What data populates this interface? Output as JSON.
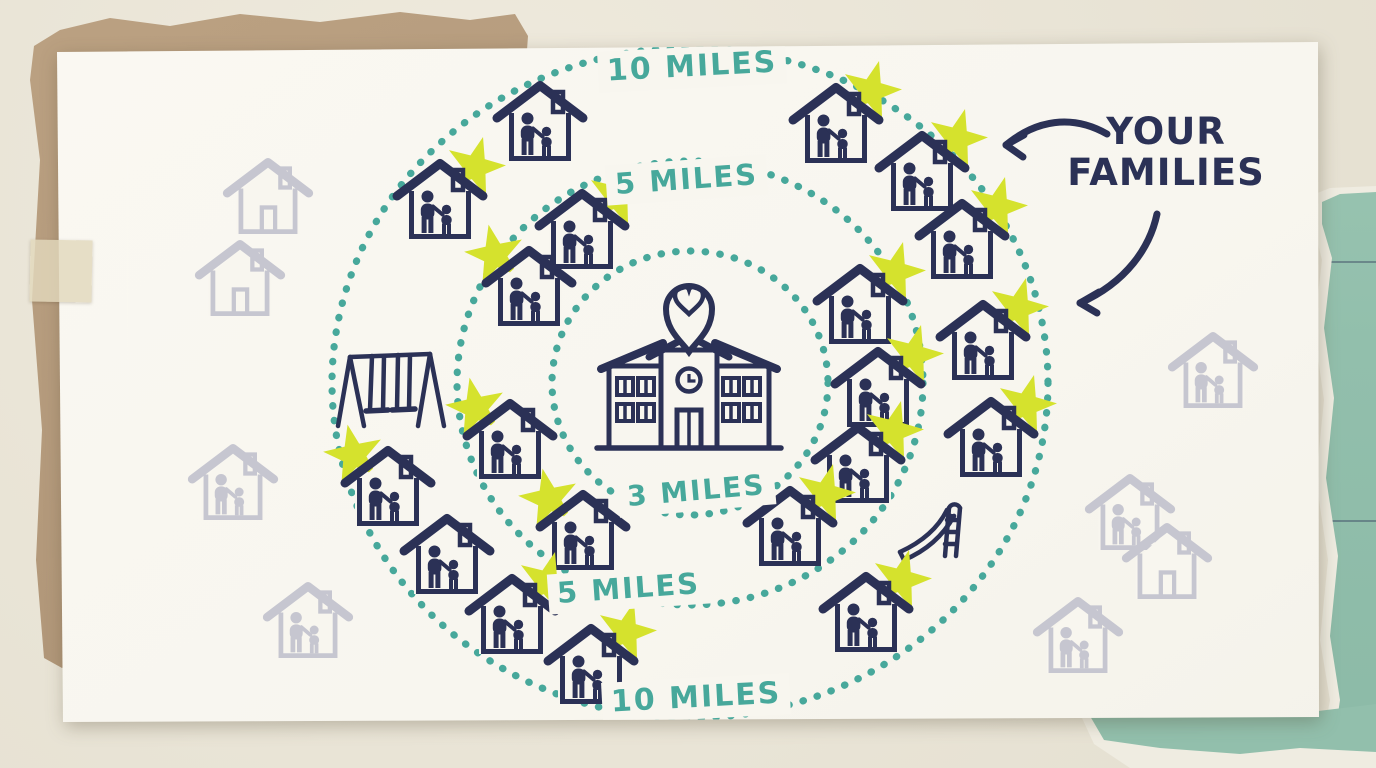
{
  "title": "Your Families radius map illustration",
  "colors": {
    "paper": "#f8f6ef",
    "background": "#e9e4d6",
    "kraft": "#b2987a",
    "teal_paper": "#92bfac",
    "accent_teal": "#47a89b",
    "navy": "#2b3156",
    "star": "#d5e22d",
    "faded": "#c6c6d0"
  },
  "center": {
    "x": 690,
    "y": 383,
    "icon": "school-with-heart-location-pin"
  },
  "rings": [
    {
      "miles": 3,
      "label": "3 MILES",
      "rx": 138,
      "ry": 132
    },
    {
      "miles": 5,
      "label": "5 MILES",
      "rx": 233,
      "ry": 222
    },
    {
      "miles": 10,
      "label": "10 MILES",
      "rx": 358,
      "ry": 335
    }
  ],
  "annotation": {
    "line1": "YOUR",
    "line2": "FAMILIES"
  },
  "houses": [
    {
      "x": 540,
      "y": 122,
      "star": null
    },
    {
      "x": 836,
      "y": 124,
      "star": "right"
    },
    {
      "x": 922,
      "y": 172,
      "star": "right"
    },
    {
      "x": 440,
      "y": 200,
      "star": "right"
    },
    {
      "x": 582,
      "y": 230,
      "star": "right"
    },
    {
      "x": 529,
      "y": 287,
      "star": "left"
    },
    {
      "x": 962,
      "y": 240,
      "star": "right"
    },
    {
      "x": 860,
      "y": 305,
      "star": "right"
    },
    {
      "x": 983,
      "y": 341,
      "star": "right"
    },
    {
      "x": 878,
      "y": 388,
      "star": "right"
    },
    {
      "x": 991,
      "y": 438,
      "star": "right"
    },
    {
      "x": 858,
      "y": 464,
      "star": "right"
    },
    {
      "x": 510,
      "y": 440,
      "star": "left"
    },
    {
      "x": 388,
      "y": 487,
      "star": "left"
    },
    {
      "x": 583,
      "y": 531,
      "star": "left"
    },
    {
      "x": 447,
      "y": 555,
      "star": null
    },
    {
      "x": 512,
      "y": 615,
      "star": "right"
    },
    {
      "x": 591,
      "y": 665,
      "star": "right"
    },
    {
      "x": 790,
      "y": 527,
      "star": "right"
    },
    {
      "x": 866,
      "y": 613,
      "star": "right"
    }
  ],
  "faded_houses": [
    {
      "x": 268,
      "y": 197,
      "variant": "empty"
    },
    {
      "x": 240,
      "y": 279,
      "variant": "empty"
    },
    {
      "x": 233,
      "y": 483,
      "variant": "family"
    },
    {
      "x": 308,
      "y": 621,
      "variant": "family"
    },
    {
      "x": 1213,
      "y": 371,
      "variant": "family"
    },
    {
      "x": 1130,
      "y": 513,
      "variant": "family"
    },
    {
      "x": 1167,
      "y": 562,
      "variant": "empty"
    },
    {
      "x": 1078,
      "y": 636,
      "variant": "family"
    }
  ],
  "playground": [
    {
      "type": "swing-set",
      "x": 390,
      "y": 390
    },
    {
      "type": "slide",
      "x": 934,
      "y": 528
    }
  ]
}
